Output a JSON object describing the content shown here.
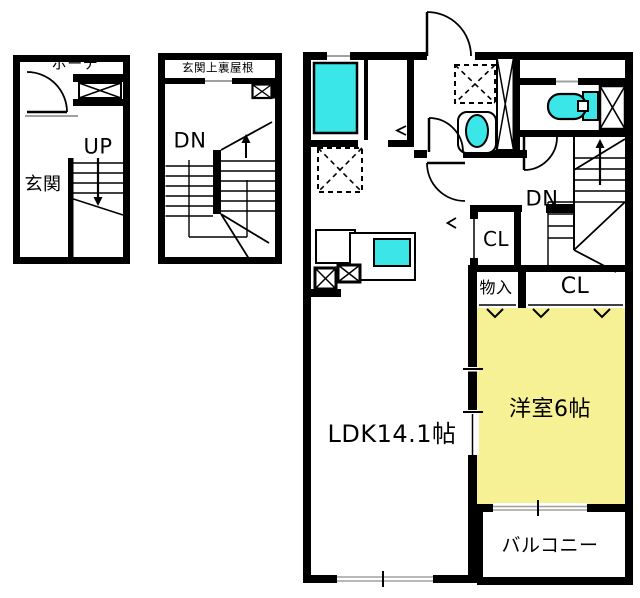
{
  "title": "apartment-floor-plan",
  "colors": {
    "wall": "#000000",
    "fixture_fill": "#3ae6e8",
    "bedroom_fill": "#f7f195",
    "window_line": "#a0a0a0",
    "background": "#ffffff"
  },
  "floor1": {
    "porch_label": "ポーチ",
    "entrance_label": "玄関",
    "stairs_up_label": "UP"
  },
  "roof_plan": {
    "title_label": "玄関上裏屋根",
    "stairs_down_label": "DN"
  },
  "floor2": {
    "ldk_label": "LDK14.1帖",
    "bedroom_label": "洋室6帖",
    "balcony_label": "バルコニー",
    "stairs_down_label": "DN",
    "hall_closet_label": "CL",
    "storage_label": "物入",
    "bedroom_closet_label": "CL"
  }
}
